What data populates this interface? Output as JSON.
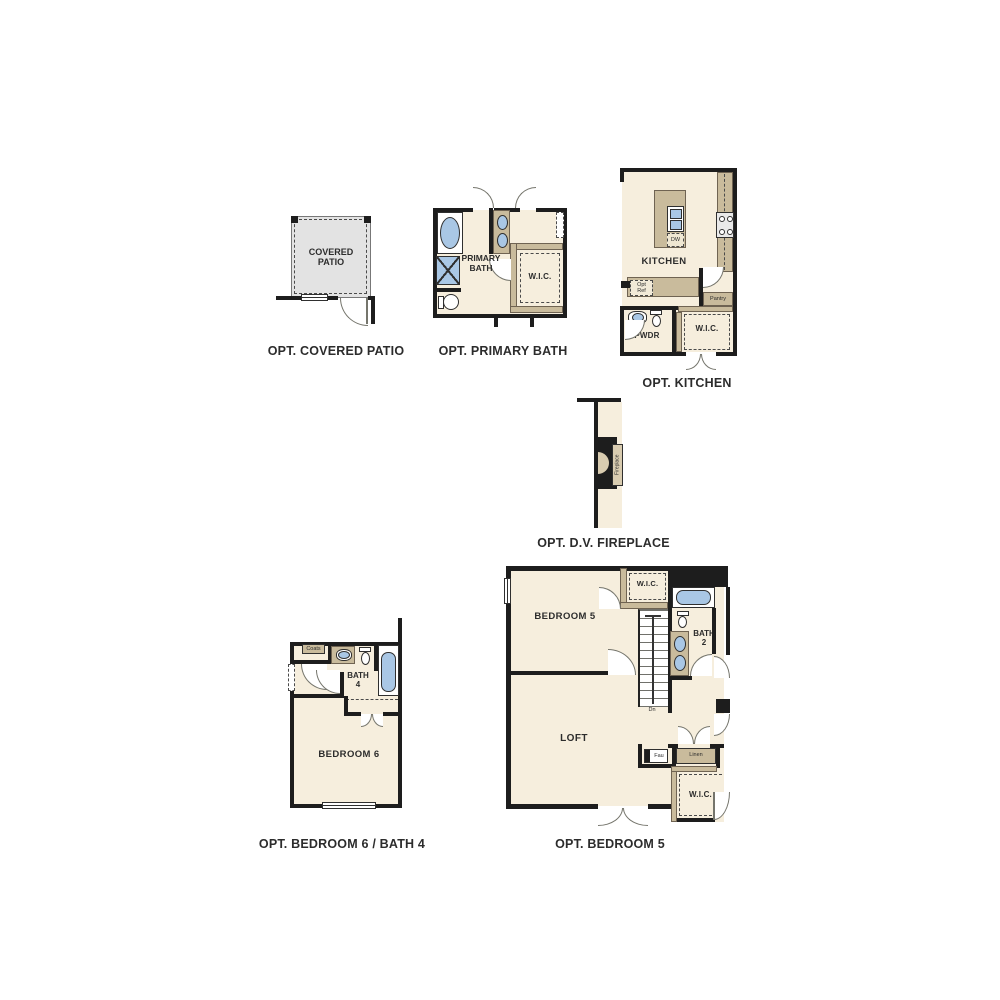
{
  "colors": {
    "wall": "#1d1d1d",
    "floor": "#f6eedd",
    "patio_floor": "#e3e3e3",
    "counter_tan": "#c9bb9c",
    "fixture_blue": "#a9c7e5",
    "door_swing": "#75756c",
    "text": "#2c2c2c"
  },
  "plans": {
    "covered_patio": {
      "title": "OPT. COVERED PATIO",
      "patio_label": "COVERED\nPATIO"
    },
    "primary_bath": {
      "title": "OPT. PRIMARY BATH",
      "bath_label": "PRIMARY\nBATH",
      "wic_label": "W.I.C."
    },
    "kitchen": {
      "title": "OPT. KITCHEN",
      "kitchen_label": "KITCHEN",
      "powder_label": "PWDR",
      "wic_label": "W.I.C.",
      "dishwasher_label": "DW",
      "opt_ref_label": "Opt\nRef",
      "pantry_label": "Pantry"
    },
    "fireplace": {
      "title": "OPT. D.V. FIREPLACE",
      "fireplace_label": "Fireplace"
    },
    "bedroom6_bath4": {
      "title": "OPT. BEDROOM 6 / BATH 4",
      "bath_label": "BATH\n4",
      "bedroom_label": "BEDROOM 6",
      "coats_label": "Coats"
    },
    "bedroom5": {
      "title": "OPT. BEDROOM 5",
      "bedroom_label": "BEDROOM 5",
      "wic_top_label": "W.I.C.",
      "bath_label": "BATH\n2",
      "loft_label": "LOFT",
      "dn_label": "Dn",
      "fau_label": "Fau",
      "linen_label": "Linen",
      "wic_bottom_label": "W.I.C."
    }
  }
}
